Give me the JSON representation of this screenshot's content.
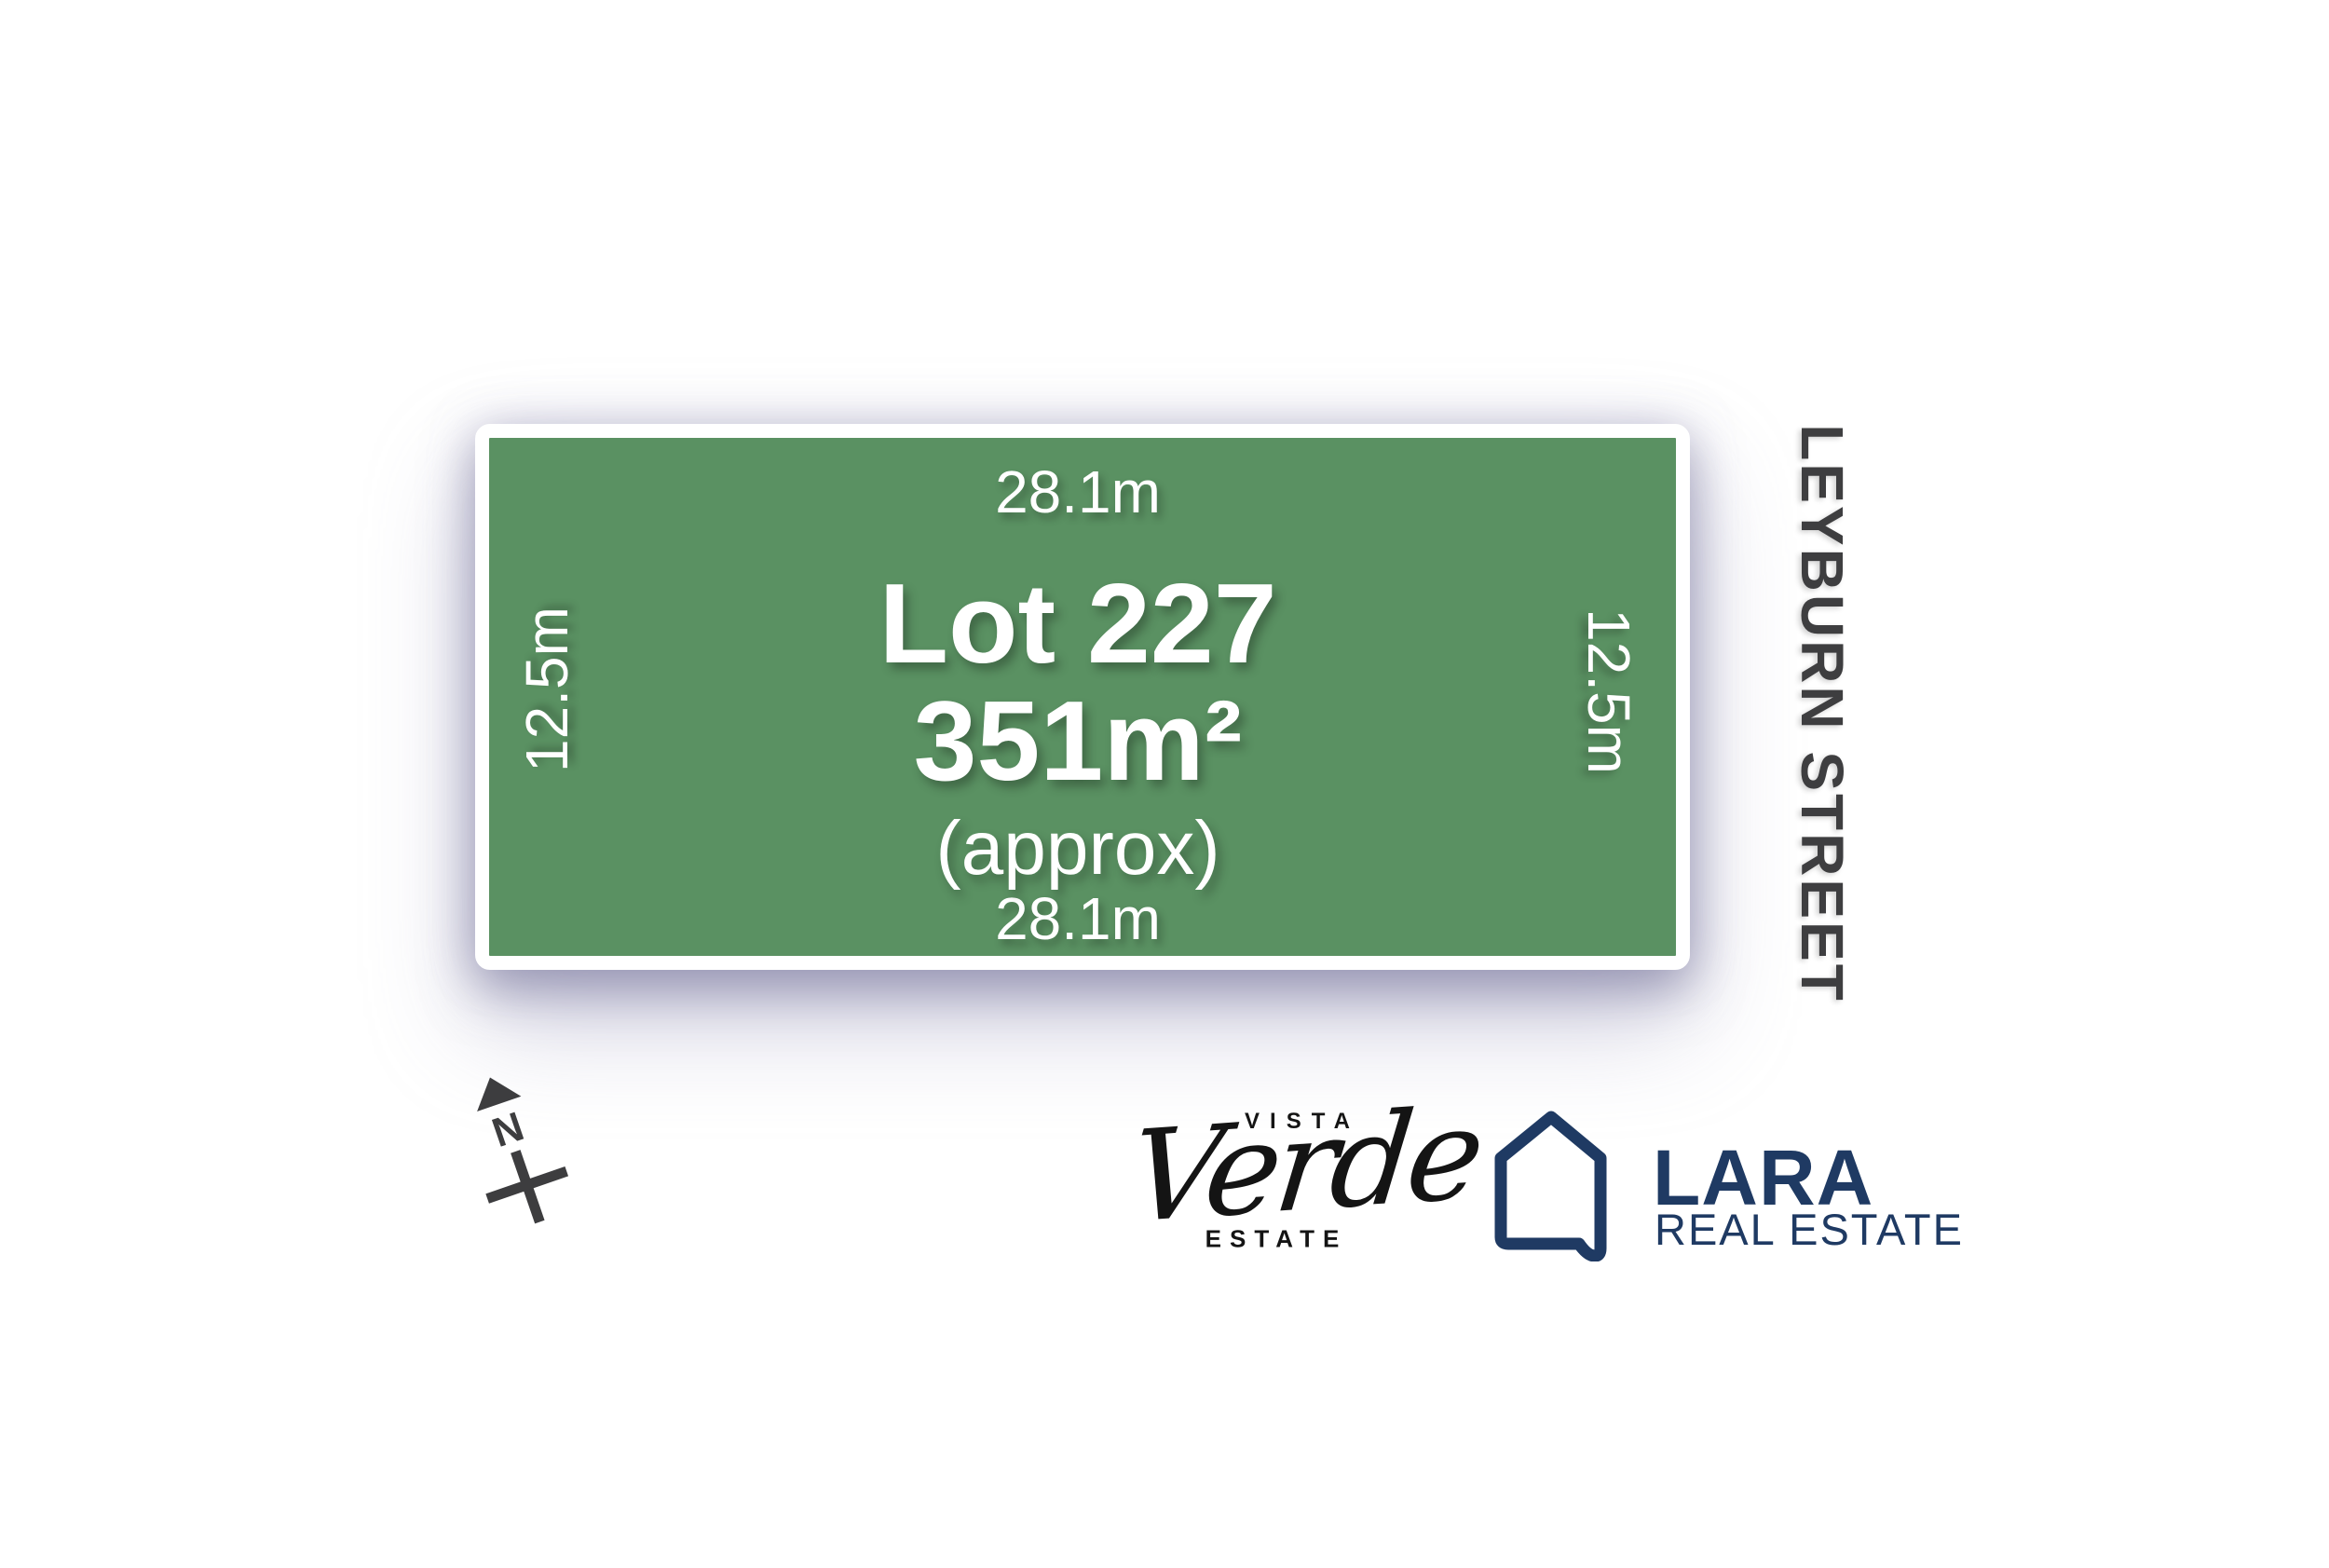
{
  "lot": {
    "name": "Lot 227",
    "area": "351m²",
    "area_note": "(approx)",
    "dim_top": "28.1m",
    "dim_bottom": "28.1m",
    "dim_left": "12.5m",
    "dim_right": "12.5m",
    "fill_color": "#5a9162",
    "border_color": "#ffffff"
  },
  "street": {
    "name": "LEYBURN STREET",
    "color": "#3e3e40"
  },
  "compass": {
    "label": "N"
  },
  "estate_logo": {
    "top_word": "VISTA",
    "script_word": "Verde",
    "bottom_word": "ESTATE",
    "color": "#141414"
  },
  "agency_logo": {
    "name": "LARA",
    "subtitle": "REAL ESTATE",
    "color": "#1f3a63"
  }
}
